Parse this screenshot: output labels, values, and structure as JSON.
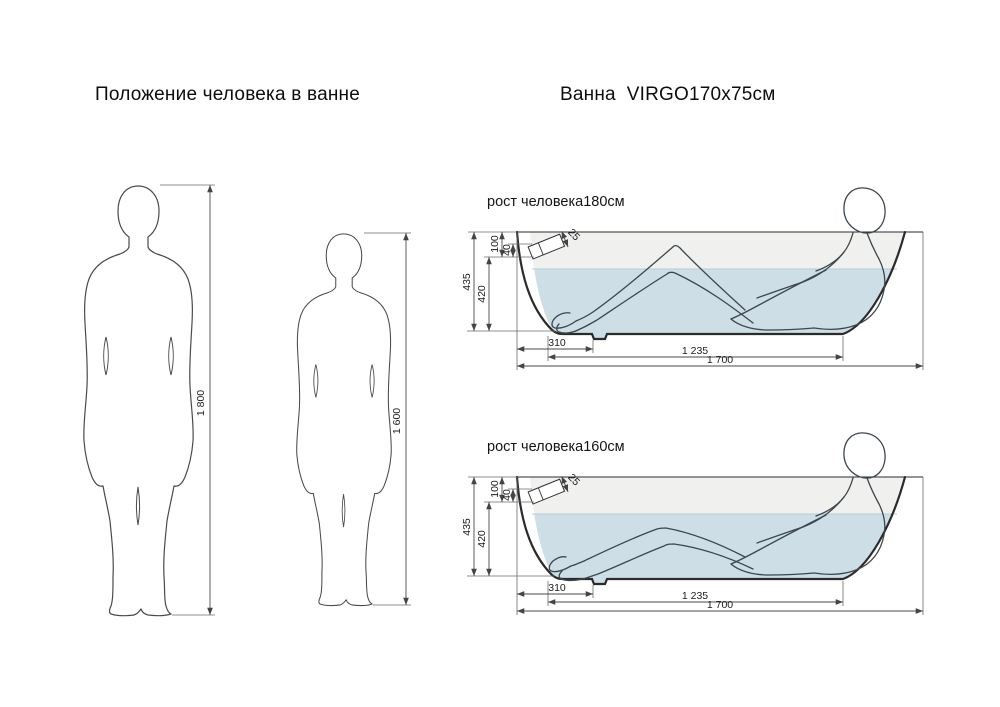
{
  "titles": {
    "left": "Положение человека в ванне",
    "right": "Ванна  VIRGO170x75см"
  },
  "figures": [
    {
      "name": "person-180",
      "height_label": "1 800"
    },
    {
      "name": "person-160",
      "height_label": "1 600"
    }
  ],
  "tubs": [
    {
      "caption": "рост человека180см",
      "dims": {
        "total_depth": "435",
        "inner_depth": "420",
        "top_offset": "100",
        "small_offset": "40",
        "overflow": "25",
        "foot_length": "310",
        "bottom_length": "1 235",
        "overall_length": "1 700"
      }
    },
    {
      "caption": "рост человека160см",
      "dims": {
        "total_depth": "435",
        "inner_depth": "420",
        "top_offset": "100",
        "small_offset": "40",
        "overflow": "25",
        "foot_length": "310",
        "bottom_length": "1 235",
        "overall_length": "1 700"
      }
    }
  ],
  "colors": {
    "water": "#cddee6",
    "air": "#f0f0ee",
    "waterline": "#b9cdd6"
  }
}
